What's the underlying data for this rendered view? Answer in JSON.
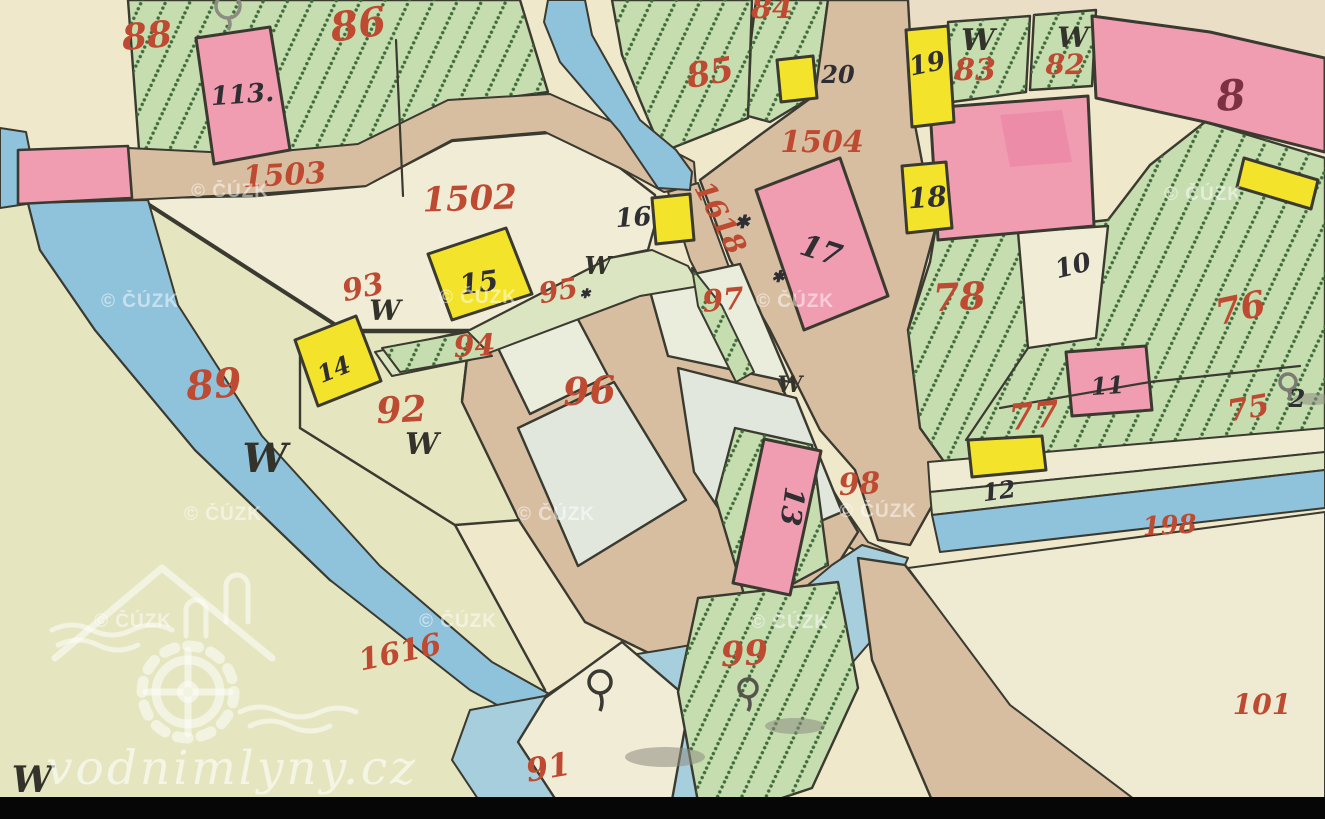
{
  "page": {
    "title": "Historic cadastral map scan (vodnimlyny.cz / ČÚZK)"
  },
  "map": {
    "width": 1325,
    "height": 819,
    "palette": {
      "bg": "#EFE8CB",
      "bgY": "#E5E6C0",
      "cream": "#F1ECD6",
      "cream2": "#EFEAD2",
      "pale": "#EAECDC",
      "bblock": "#E2E7DE",
      "green": "#C6DDAF",
      "greenPale": "#DCE5C1",
      "road": "#D8BEA1",
      "plateau": "#EADFC6",
      "pink": "#F09DB2",
      "pinkDeep": "#ED8CA8",
      "yellow": "#F3E32B",
      "water": "#8FC2DB",
      "pond": "#A7CEDD",
      "ink": "#3B3A30",
      "red": "#BE4A31",
      "black": "#2F2E33",
      "maroon": "#7C3140",
      "gray": "#8C8C82"
    },
    "shapes": [
      {
        "n": "background",
        "f": "bg",
        "p": "0,0 1325,0 1325,819 0,819",
        "s": 0
      },
      {
        "n": "meadow-southwest",
        "f": "bgY",
        "p": "0,205 148,200 178,305 262,436 380,566 492,662 560,702 640,748 700,800 700,819 0,819",
        "s": 0
      },
      {
        "n": "plateau-northeast",
        "f": "plateau",
        "p": "905,0 1325,0 1325,60 1200,34 1095,14 1000,16 940,24 908,60",
        "s": 0
      },
      {
        "n": "field-86-green",
        "f": "green",
        "p": "128,0 520,0 548,92 445,106 360,148 250,160 140,163",
        "h": true
      },
      {
        "n": "parcel-1502",
        "f": "cream",
        "p": "140,198 255,196 365,186 452,141 548,133 620,168 655,195 655,225 648,250 610,258 470,330 345,330"
      },
      {
        "n": "parcel-89",
        "f": "bgY",
        "p": "140,200 345,332 300,428 455,525 545,690 518,702 330,580 195,450 95,330 40,250 28,203"
      },
      {
        "n": "parcel-92",
        "f": "bgY",
        "p": "300,345 345,332 470,332 462,400 520,520 455,525 300,428"
      },
      {
        "n": "field-85-green",
        "f": "green",
        "p": "612,0 752,0 748,118 662,152 640,100 622,55",
        "h": true
      },
      {
        "n": "field-84-green",
        "f": "green",
        "p": "756,0 828,0 815,95 770,122 748,116 751,40",
        "h": true
      },
      {
        "n": "road-1503",
        "f": "road",
        "p": "128,148 250,154 358,144 448,100 550,94 648,138 694,162 696,186 664,192 620,168 545,132 452,140 366,186 254,194 130,200",
        "w": 2
      },
      {
        "n": "road-square-1504",
        "f": "road",
        "p": "828,0 908,0 915,125 935,230 908,330 925,430 952,470 910,545 878,540 855,470 820,430 770,330 730,260 700,180 760,135 815,95"
      },
      {
        "n": "lane-1618",
        "f": "road",
        "p": "668,192 698,183 730,270 775,380 825,480 868,542 905,558 895,572 845,545 795,470 742,360 690,260",
        "w": 2
      },
      {
        "n": "village-block-base",
        "f": "road",
        "p": "470,332 610,262 700,274 770,362 822,472 858,532 815,600 740,630 655,656 585,622 520,522 462,402"
      },
      {
        "n": "village-block-nw",
        "f": "pale",
        "p": "495,342 572,308 608,376 530,414"
      },
      {
        "n": "village-block-96",
        "f": "bblock",
        "p": "518,428 614,382 686,500 578,566"
      },
      {
        "n": "village-block-97",
        "f": "pale",
        "p": "648,284 740,264 790,382 668,356"
      },
      {
        "n": "village-block-se",
        "f": "bblock",
        "p": "678,368 796,398 842,512 748,552 694,472"
      },
      {
        "n": "strip-94-95",
        "f": "greenPale",
        "p": "375,352 470,330 610,258 652,250 688,266 700,286 640,296 470,360 392,376",
        "w": 2
      },
      {
        "n": "strip-94-hatch",
        "f": "green",
        "p": "382,348 468,332 492,356 400,372",
        "h": true,
        "w": 2
      },
      {
        "n": "sliver-green-road",
        "f": "green",
        "p": "692,268 722,306 754,372 736,382 698,306",
        "h": true,
        "w": 2
      },
      {
        "n": "patch-13-green",
        "f": "green",
        "p": "735,428 812,445 828,565 748,608 716,500",
        "h": true
      },
      {
        "n": "field-83-green",
        "f": "green",
        "p": "948,22 1030,16 1026,92 952,102",
        "h": true
      },
      {
        "n": "field-82-green",
        "f": "green",
        "p": "1034,15 1096,10 1092,86 1030,90",
        "h": true
      },
      {
        "n": "field-east-green",
        "f": "green",
        "p": "935,232 1018,230 1108,220 1150,165 1205,122 1325,158 1325,430 1230,440 1100,452 1010,462 950,470 920,428 908,330 930,262",
        "h": true
      },
      {
        "n": "parcel-10-inset",
        "f": "cream",
        "p": "1018,232 1108,226 1096,338 1028,348"
      },
      {
        "n": "band-river-road",
        "f": "cream2",
        "p": "928,462 1325,428 1325,452 930,492",
        "w": 2
      },
      {
        "n": "band-river-green",
        "f": "greenPale",
        "p": "930,492 1325,452 1325,470 932,515",
        "w": 2
      },
      {
        "n": "band-river-water",
        "f": "water",
        "p": "932,515 1325,470 1325,508 940,552",
        "w": 2
      },
      {
        "n": "stream-north",
        "f": "water",
        "p": "548,0 585,0 592,35 640,120 676,150 692,172 690,190 658,188 620,132 560,62 544,22",
        "w": 2
      },
      {
        "n": "stream-west",
        "f": "water",
        "p": "28,203 148,200 178,305 262,436 380,566 492,662 560,700 632,745 608,766 470,690 330,580 195,450 95,330 40,250",
        "w": 2
      },
      {
        "n": "stream-corner",
        "f": "water",
        "p": "0,128 26,132 40,202 0,208",
        "w": 2
      },
      {
        "n": "pond-south",
        "f": "pond",
        "p": "862,545 908,558 872,640 820,700 760,755 700,802 480,802 452,760 470,710 545,696 600,660 662,650 720,640 790,600 832,565",
        "w": 2
      },
      {
        "n": "wedge-91",
        "f": "cream",
        "p": "518,742 545,698 622,642 690,700 672,800 556,800"
      },
      {
        "n": "parcel-99-green",
        "f": "green",
        "p": "698,598 838,582 858,688 812,788 770,802 698,802 678,692",
        "h": true
      },
      {
        "n": "road-southeast",
        "f": "road",
        "p": "858,558 905,565 1010,700 1200,800 1160,819 940,819 872,660"
      },
      {
        "n": "parcel-101",
        "f": "cream2",
        "p": "908,568 1325,512 1325,815 1155,815 1010,705",
        "w": 2
      },
      {
        "n": "bridge-strip-pink",
        "f": "pink",
        "p": "18,150 128,146 132,198 18,204",
        "w": 2.6
      },
      {
        "n": "building-113",
        "f": "pink",
        "p": "196,38 270,27 290,150 214,164",
        "w": 3
      },
      {
        "n": "building-17",
        "f": "pink",
        "p": "756,190 840,158 888,296 804,330",
        "w": 3
      },
      {
        "n": "building-8",
        "f": "pink",
        "p": "1092,16 1210,32 1325,58 1325,152 1205,122 1096,98",
        "w": 3
      },
      {
        "n": "building-unlabeled-big",
        "f": "pink",
        "p": "930,108 1088,96 1094,226 938,240",
        "w": 3
      },
      {
        "n": "building-blotch",
        "f": "pinkDeep",
        "p": "1000,115 1062,110 1072,162 1010,167",
        "s": 0
      },
      {
        "n": "building-11",
        "f": "pink",
        "p": "1066,352 1146,346 1152,410 1072,416",
        "w": 3
      },
      {
        "n": "building-13",
        "f": "pink",
        "p": "821,451 764,439 733,583 790,595",
        "w": 3
      },
      {
        "n": "building-19",
        "f": "yellow",
        "p": "906,30 948,26 954,122 912,127",
        "w": 3
      },
      {
        "n": "building-20",
        "f": "yellow",
        "p": "777,60 813,56 817,98 781,102",
        "w": 3
      },
      {
        "n": "building-18",
        "f": "yellow",
        "p": "902,166 946,162 952,228 907,233",
        "w": 3
      },
      {
        "n": "building-16",
        "f": "yellow",
        "p": "652,198 690,194 694,240 656,244",
        "w": 3
      },
      {
        "n": "building-15",
        "f": "yellow",
        "p": "428,254 506,228 532,294 452,320",
        "w": 3
      },
      {
        "n": "building-14",
        "f": "yellow",
        "p": "295,340 356,316 381,381 318,406",
        "w": 3
      },
      {
        "n": "building-12",
        "f": "yellow",
        "p": "968,440 1042,436 1046,470 972,477",
        "w": 3
      },
      {
        "n": "building-east-edge",
        "f": "yellow",
        "p": "1244,158 1318,180 1311,209 1237,187",
        "w": 3
      }
    ],
    "boundaries": [
      {
        "n": "split-86-88",
        "p": "396,40 403,196"
      },
      {
        "n": "split-78-77",
        "p": "1028,348 966,440"
      },
      {
        "n": "split-76-75",
        "p": "1000,408 1150,382 1300,366"
      }
    ],
    "labels": [
      {
        "t": "88",
        "x": 148,
        "y": 48,
        "s": 36,
        "c": "r",
        "r": -5
      },
      {
        "t": "86",
        "x": 360,
        "y": 38,
        "s": 40,
        "c": "r",
        "r": -8
      },
      {
        "t": "1503",
        "x": 285,
        "y": 185,
        "s": 30,
        "c": "r",
        "r": -3
      },
      {
        "t": "1502",
        "x": 470,
        "y": 210,
        "s": 34,
        "c": "r",
        "r": -2
      },
      {
        "t": "85",
        "x": 712,
        "y": 84,
        "s": 34,
        "c": "r",
        "r": -10
      },
      {
        "t": "84",
        "x": 772,
        "y": 18,
        "s": 30,
        "c": "r"
      },
      {
        "t": "1504",
        "x": 822,
        "y": 152,
        "s": 30,
        "c": "r"
      },
      {
        "t": "83",
        "x": 975,
        "y": 80,
        "s": 30,
        "c": "r"
      },
      {
        "t": "82",
        "x": 1065,
        "y": 74,
        "s": 28,
        "c": "r"
      },
      {
        "t": "1618",
        "x": 712,
        "y": 222,
        "s": 28,
        "c": "r",
        "r": 62
      },
      {
        "t": "93",
        "x": 365,
        "y": 297,
        "s": 30,
        "c": "r",
        "r": -12
      },
      {
        "t": "94",
        "x": 475,
        "y": 356,
        "s": 30,
        "c": "r",
        "r": -3
      },
      {
        "t": "95",
        "x": 560,
        "y": 300,
        "s": 28,
        "c": "r",
        "r": -10
      },
      {
        "t": "97",
        "x": 724,
        "y": 310,
        "s": 30,
        "c": "r",
        "r": -5
      },
      {
        "t": "96",
        "x": 590,
        "y": 404,
        "s": 38,
        "c": "r",
        "r": -3
      },
      {
        "t": "89",
        "x": 215,
        "y": 398,
        "s": 40,
        "c": "r",
        "r": -5
      },
      {
        "t": "92",
        "x": 402,
        "y": 422,
        "s": 36,
        "c": "r",
        "r": -3
      },
      {
        "t": "78",
        "x": 960,
        "y": 310,
        "s": 38,
        "c": "r",
        "r": -3
      },
      {
        "t": "76",
        "x": 1243,
        "y": 320,
        "s": 36,
        "c": "r",
        "r": -12
      },
      {
        "t": "77",
        "x": 1035,
        "y": 428,
        "s": 36,
        "c": "r",
        "r": -5
      },
      {
        "t": "75",
        "x": 1250,
        "y": 418,
        "s": 30,
        "c": "r",
        "r": -10
      },
      {
        "t": "98",
        "x": 860,
        "y": 494,
        "s": 30,
        "c": "r",
        "r": -3
      },
      {
        "t": "99",
        "x": 745,
        "y": 665,
        "s": 34,
        "c": "r",
        "r": -3
      },
      {
        "t": "1616",
        "x": 402,
        "y": 662,
        "s": 30,
        "c": "r",
        "r": -12
      },
      {
        "t": "91",
        "x": 550,
        "y": 778,
        "s": 32,
        "c": "r",
        "r": -10
      },
      {
        "t": "101",
        "x": 1262,
        "y": 714,
        "s": 28,
        "c": "r"
      },
      {
        "t": "198",
        "x": 1170,
        "y": 534,
        "s": 26,
        "c": "r",
        "r": -3
      },
      {
        "t": "113.",
        "x": 243,
        "y": 103,
        "s": 26,
        "c": "k",
        "r": -4
      },
      {
        "t": "20",
        "x": 838,
        "y": 83,
        "s": 24,
        "c": "k"
      },
      {
        "t": "19",
        "x": 929,
        "y": 72,
        "s": 26,
        "c": "k",
        "r": -12
      },
      {
        "t": "18",
        "x": 928,
        "y": 207,
        "s": 28,
        "c": "k",
        "r": -4
      },
      {
        "t": "16",
        "x": 634,
        "y": 226,
        "s": 26,
        "c": "k",
        "r": -4
      },
      {
        "t": "17",
        "x": 818,
        "y": 260,
        "s": 30,
        "c": "k",
        "r": 18
      },
      {
        "t": "15",
        "x": 480,
        "y": 292,
        "s": 28,
        "c": "k",
        "r": -8
      },
      {
        "t": "14",
        "x": 337,
        "y": 377,
        "s": 24,
        "c": "k",
        "r": -22
      },
      {
        "t": "12",
        "x": 1000,
        "y": 499,
        "s": 24,
        "c": "k",
        "r": -8
      },
      {
        "t": "10",
        "x": 1075,
        "y": 274,
        "s": 26,
        "c": "k",
        "r": -14
      },
      {
        "t": "11",
        "x": 1108,
        "y": 394,
        "s": 24,
        "c": "k",
        "r": -4
      },
      {
        "t": "13",
        "x": 783,
        "y": 505,
        "s": 28,
        "c": "k",
        "r": 98
      },
      {
        "t": "2",
        "x": 1297,
        "y": 407,
        "s": 24,
        "c": "k"
      },
      {
        "t": "8",
        "x": 1232,
        "y": 110,
        "s": 42,
        "c": "m",
        "r": -4
      },
      {
        "t": "W",
        "x": 265,
        "y": 472,
        "s": 40,
        "c": "w"
      },
      {
        "t": "W",
        "x": 422,
        "y": 454,
        "s": 30,
        "c": "w"
      },
      {
        "t": "W",
        "x": 385,
        "y": 320,
        "s": 28,
        "c": "w"
      },
      {
        "t": "W",
        "x": 598,
        "y": 274,
        "s": 24,
        "c": "w"
      },
      {
        "t": "W",
        "x": 978,
        "y": 50,
        "s": 30,
        "c": "w"
      },
      {
        "t": "W",
        "x": 1073,
        "y": 47,
        "s": 28,
        "c": "w"
      },
      {
        "t": "W",
        "x": 790,
        "y": 392,
        "s": 22,
        "c": "w"
      },
      {
        "t": "W",
        "x": 32,
        "y": 792,
        "s": 36,
        "c": "w"
      }
    ],
    "stars": [
      {
        "x": 742,
        "y": 228,
        "s": 18
      },
      {
        "x": 778,
        "y": 282,
        "s": 16
      },
      {
        "x": 585,
        "y": 298,
        "s": 13
      }
    ],
    "trees": [
      {
        "x": 600,
        "y": 682,
        "r": 11,
        "c": "#3A3A32",
        "trunk": 18
      },
      {
        "x": 748,
        "y": 688,
        "r": 9,
        "c": "#55554C",
        "trunk": 14
      },
      {
        "x": 1288,
        "y": 382,
        "r": 8,
        "c": "#7A7A70",
        "trunk": 10
      },
      {
        "x": 228,
        "y": 6,
        "r": 12,
        "c": "#8C8C82",
        "trunk": 12
      }
    ],
    "shadows": [
      {
        "cx": 665,
        "cy": 757,
        "rx": 40,
        "ry": 10
      },
      {
        "cx": 795,
        "cy": 726,
        "rx": 30,
        "ry": 8
      },
      {
        "cx": 1313,
        "cy": 399,
        "rx": 20,
        "ry": 6
      }
    ],
    "watermarks": {
      "cuzk": {
        "text": "© ČÚZK",
        "positions": [
          {
            "x": 230,
            "y": 197
          },
          {
            "x": 140,
            "y": 307
          },
          {
            "x": 478,
            "y": 303
          },
          {
            "x": 795,
            "y": 307
          },
          {
            "x": 1203,
            "y": 200
          },
          {
            "x": 878,
            "y": 517
          },
          {
            "x": 223,
            "y": 520
          },
          {
            "x": 556,
            "y": 520
          },
          {
            "x": 133,
            "y": 627
          },
          {
            "x": 458,
            "y": 627
          },
          {
            "x": 790,
            "y": 628
          }
        ]
      },
      "site": {
        "text": "vodnimlyny.cz"
      }
    }
  }
}
